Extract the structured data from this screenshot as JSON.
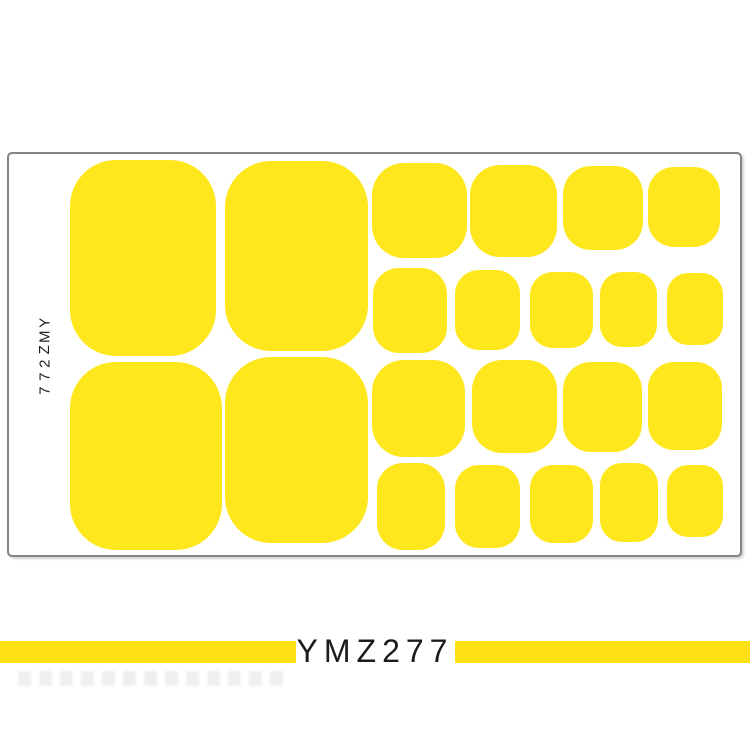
{
  "colors": {
    "sticker_yellow": "#FFE71E",
    "banner_yellow": "#FFE113",
    "sheet_border": "#848484",
    "text_black": "#1B1B1B"
  },
  "sheet": {
    "side_label": "YMZ277",
    "stickers": [
      {
        "id": "big-1",
        "x": 70,
        "y": 160,
        "w": 146,
        "h": 196,
        "r": 46
      },
      {
        "id": "big-2",
        "x": 225,
        "y": 161,
        "w": 143,
        "h": 190,
        "r": 46
      },
      {
        "id": "big-3",
        "x": 70,
        "y": 362,
        "w": 152,
        "h": 188,
        "r": 46
      },
      {
        "id": "big-4",
        "x": 225,
        "y": 357,
        "w": 143,
        "h": 186,
        "r": 46
      },
      {
        "id": "medium-1",
        "x": 372,
        "y": 163,
        "w": 95,
        "h": 95,
        "r": 32
      },
      {
        "id": "medium-2",
        "x": 470,
        "y": 165,
        "w": 87,
        "h": 92,
        "r": 30
      },
      {
        "id": "medium-3",
        "x": 563,
        "y": 166,
        "w": 80,
        "h": 84,
        "r": 28
      },
      {
        "id": "medium-4",
        "x": 648,
        "y": 167,
        "w": 72,
        "h": 80,
        "r": 26
      },
      {
        "id": "small-1",
        "x": 373,
        "y": 268,
        "w": 74,
        "h": 85,
        "r": 26
      },
      {
        "id": "small-2",
        "x": 455,
        "y": 270,
        "w": 65,
        "h": 80,
        "r": 24
      },
      {
        "id": "small-3",
        "x": 530,
        "y": 272,
        "w": 63,
        "h": 76,
        "r": 23
      },
      {
        "id": "small-4",
        "x": 600,
        "y": 272,
        "w": 57,
        "h": 75,
        "r": 22
      },
      {
        "id": "small-5",
        "x": 667,
        "y": 273,
        "w": 56,
        "h": 72,
        "r": 21
      },
      {
        "id": "medium-5",
        "x": 372,
        "y": 360,
        "w": 93,
        "h": 97,
        "r": 32
      },
      {
        "id": "medium-6",
        "x": 472,
        "y": 360,
        "w": 85,
        "h": 93,
        "r": 30
      },
      {
        "id": "medium-7",
        "x": 563,
        "y": 362,
        "w": 79,
        "h": 90,
        "r": 28
      },
      {
        "id": "medium-8",
        "x": 648,
        "y": 362,
        "w": 74,
        "h": 88,
        "r": 26
      },
      {
        "id": "small-6",
        "x": 377,
        "y": 463,
        "w": 68,
        "h": 87,
        "r": 26
      },
      {
        "id": "small-7",
        "x": 455,
        "y": 465,
        "w": 65,
        "h": 83,
        "r": 24
      },
      {
        "id": "small-8",
        "x": 530,
        "y": 465,
        "w": 63,
        "h": 78,
        "r": 23
      },
      {
        "id": "small-9",
        "x": 600,
        "y": 463,
        "w": 58,
        "h": 79,
        "r": 22
      },
      {
        "id": "small-10",
        "x": 667,
        "y": 465,
        "w": 56,
        "h": 72,
        "r": 21
      }
    ]
  },
  "banner": {
    "label": "YMZ277"
  }
}
